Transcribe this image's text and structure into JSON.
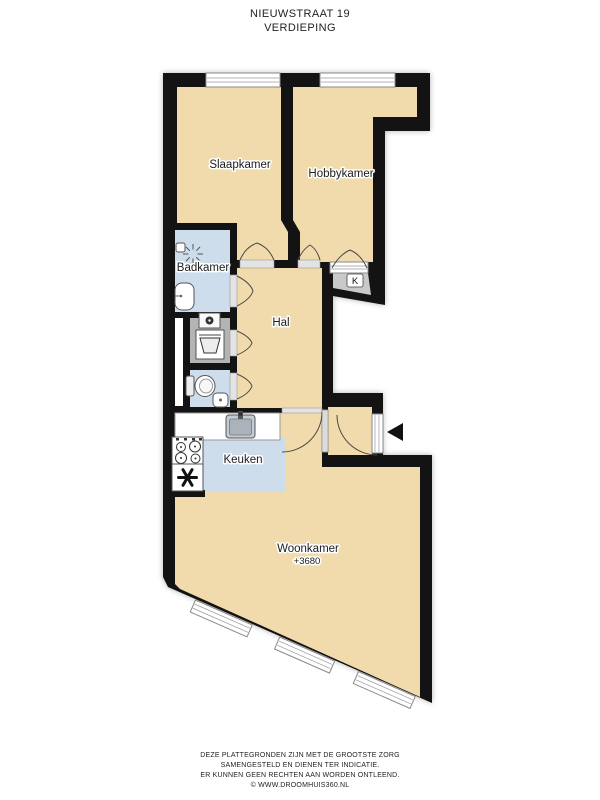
{
  "header": {
    "address": "NIEUWSTRAAT 19",
    "floor": "VERDIEPING"
  },
  "floorplan": {
    "rooms": {
      "slaapkamer": {
        "label": "Slaapkamer"
      },
      "hobbykamer": {
        "label": "Hobbykamer"
      },
      "badkamer": {
        "label": "Badkamer"
      },
      "hal": {
        "label": "Hal"
      },
      "keuken": {
        "label": "Keuken"
      },
      "woonkamer": {
        "label": "Woonkamer",
        "level": "+3680"
      },
      "kast": {
        "label": "K"
      }
    },
    "icons": {
      "entrance_arrow": "entrance-arrow",
      "shower": "shower-icon",
      "bath_sink": "sink-icon",
      "washing_machine": "washing-machine-icon",
      "toilet": "toilet-icon",
      "hand_sink": "hand-sink-icon",
      "kitchen_sink": "kitchen-sink-icon",
      "stove": "stove-icon",
      "ventilation": "asterisk-icon"
    },
    "colors": {
      "wall": "#131313",
      "room_fill": "#f1dbac",
      "wet_room_fill": "#cdddec",
      "utility_fill": "#b4b4b4",
      "closet_fill": "#c9c9c9",
      "background": "#ffffff",
      "window_fill": "#ffffff"
    }
  },
  "footer": {
    "line1": "DEZE PLATTEGRONDEN ZIJN MET DE GROOTSTE ZORG",
    "line2": "SAMENGESTELD EN DIENEN TER INDICATIE.",
    "line3": "ER KUNNEN GEEN RECHTEN AAN WORDEN ONTLEEND.",
    "line4": "© WWW.DROOMHUIS360.NL"
  }
}
